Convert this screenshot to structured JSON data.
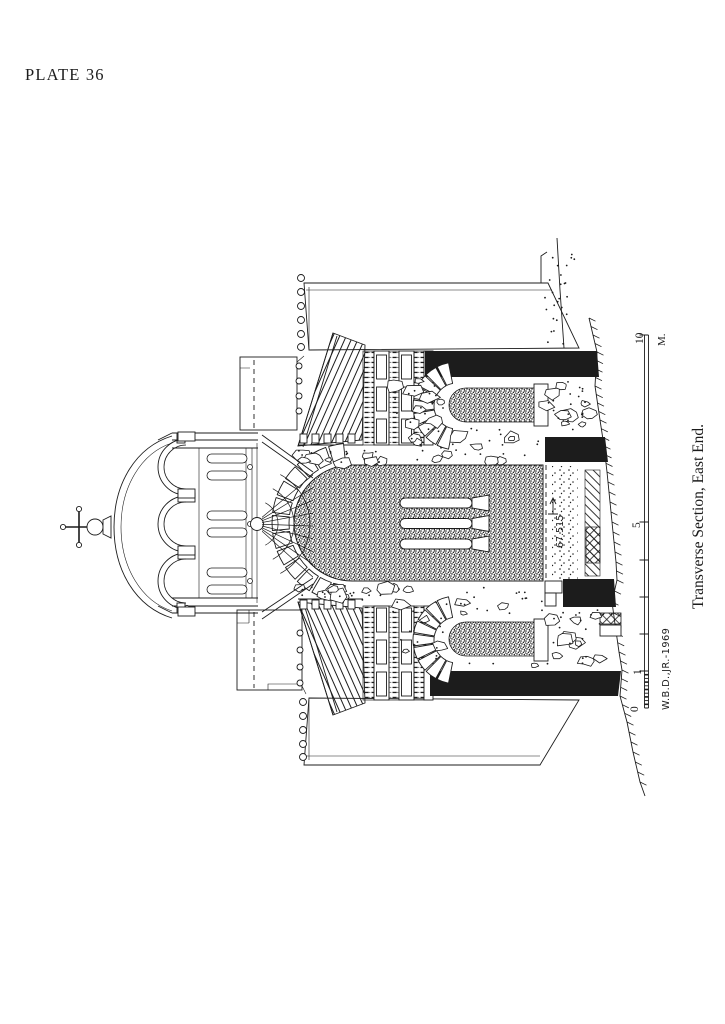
{
  "plate": {
    "label": "PLATE 36"
  },
  "caption": "Transverse Section, East End.",
  "scale": {
    "zero": "0",
    "one": "1",
    "five": "5",
    "ten": "10",
    "unit": "M."
  },
  "signature": "W.B.D.,JR.-1969",
  "elevation": "67.515",
  "colors": {
    "ink": "#1c1c1c",
    "paper": "#ffffff"
  }
}
